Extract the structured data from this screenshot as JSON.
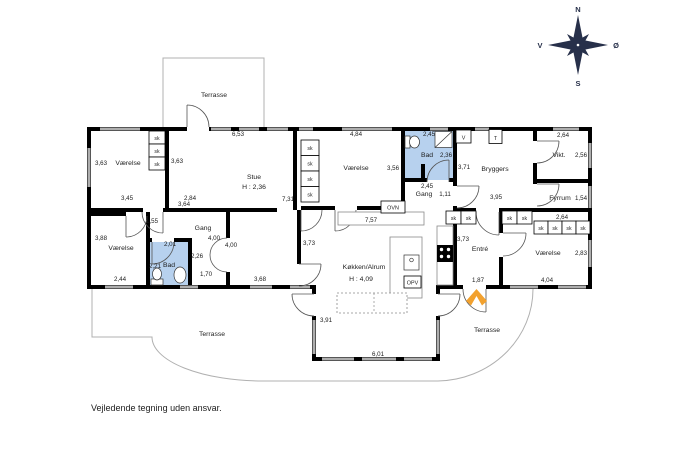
{
  "title": "Floor plan",
  "footer": {
    "disclaimer": "Vejledende tegning uden ansvar."
  },
  "compass": {
    "north": "N",
    "south": "S",
    "west": "V",
    "east": "Ø"
  },
  "colors": {
    "wall": "#000000",
    "window": "#aeaeae",
    "bath_fill": "#b7d1ee",
    "accent_arrow": "#f2a12e",
    "compass": "#27304a",
    "terrace_line": "#b0b0b0",
    "ink": "#1c1c1c"
  },
  "labels": {
    "closet": "sk",
    "oven": "OVN",
    "dishwasher": "OPV",
    "washer": "V",
    "dryer": "T"
  },
  "rooms": {
    "terrasse_top": {
      "label": "Terrasse"
    },
    "terrasse_sw": {
      "label": "Terrasse"
    },
    "terrasse_se": {
      "label": "Terrasse"
    },
    "vaerelse_nw": {
      "label": "Værelse"
    },
    "stue": {
      "label": "Stue",
      "height": "H : 2,36"
    },
    "vaerelse_n": {
      "label": "Værelse"
    },
    "bad_n": {
      "label": "Bad"
    },
    "gang_n": {
      "label": "Gang"
    },
    "bryggers": {
      "label": "Bryggers"
    },
    "vikt": {
      "label": "Vikt."
    },
    "fyrrum": {
      "label": "Fyrrum"
    },
    "vaerelse_sw": {
      "label": "Værelse"
    },
    "bad_s": {
      "label": "Bad"
    },
    "gang_s": {
      "label": "Gang"
    },
    "koekken": {
      "label": "Køkken/Alrum",
      "height": "H : 4,09"
    },
    "entre": {
      "label": "Entré"
    },
    "vaerelse_se": {
      "label": "Værelse"
    }
  },
  "dims": [
    "6,53",
    "3,63",
    "3,63",
    "3,45",
    "2,84",
    "3,64",
    "7,31",
    "4,84",
    "3,56",
    "2,45",
    "2,36",
    "2,45",
    "1,11",
    "3,71",
    "3,95",
    "2,64",
    "2,56",
    "1,54",
    "2,64",
    "7,57",
    "1,55",
    "2,01",
    "2,21",
    "2,26",
    "1,70",
    "4,00",
    "4,00",
    "3,68",
    "2,44",
    "3,88",
    "3,73",
    "3,73",
    "1,87",
    "2,83",
    "4,04",
    "3,91",
    "6,01"
  ]
}
